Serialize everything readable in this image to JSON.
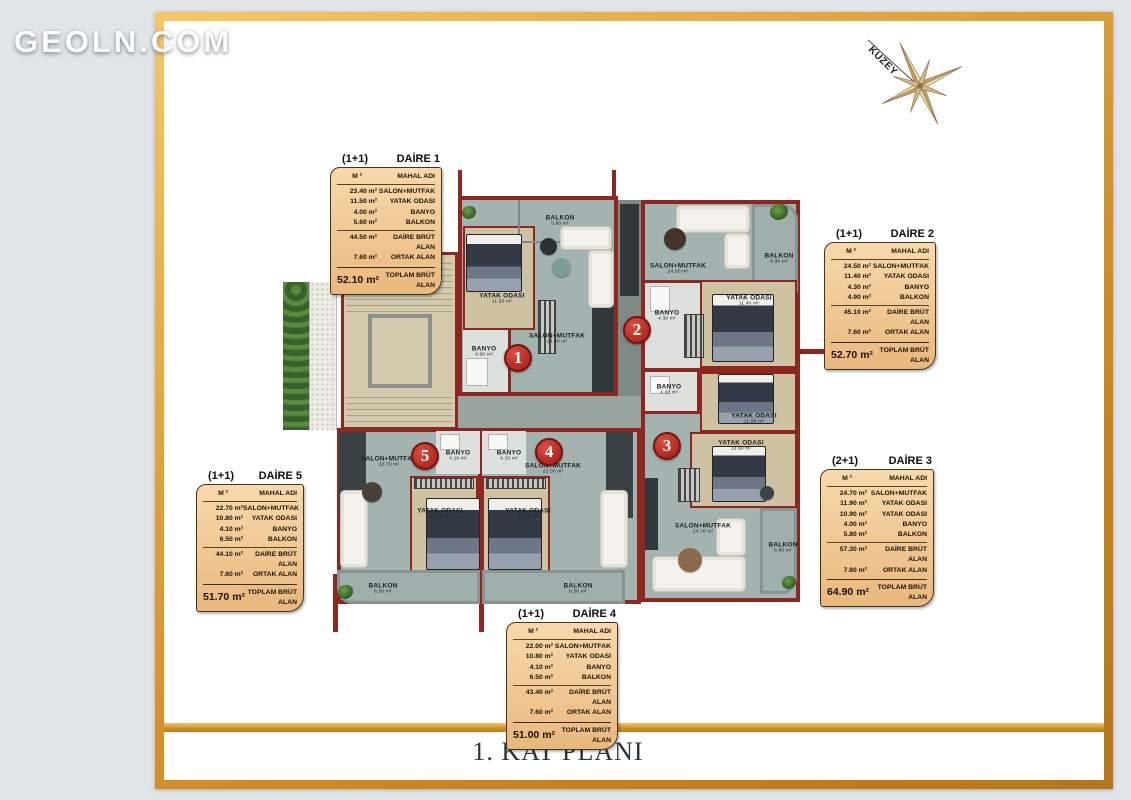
{
  "logo": "GEOLN.COM",
  "compass": {
    "label": "KUZEY"
  },
  "floor_title": "1. KAT PLANI",
  "colors": {
    "frame_gold": "#d99b35",
    "wall_red": "#8e2720",
    "card_bg": "#f3cf9d",
    "badge_red": "#c23a31",
    "floor_gray_green": "#a3b3af",
    "bedroom_beige": "#cfc2a2",
    "page_bg": "#e0e5e8"
  },
  "cards": [
    {
      "type": "(1+1)",
      "name": "DAİRE 1",
      "col_area": "M ²",
      "col_room": "MAHAL ADI",
      "rows": [
        [
          "23.40 m²",
          "SALON+MUTFAK"
        ],
        [
          "11.50 m²",
          "YATAK ODASI"
        ],
        [
          "4.00 m²",
          "BANYO"
        ],
        [
          "5.60 m²",
          "BALKON"
        ]
      ],
      "subtotal": [
        [
          "44.50 m²",
          "DAİRE BRÜT ALAN"
        ],
        [
          "7.60 m²",
          "ORTAK ALAN"
        ]
      ],
      "total": [
        "52.10 m²",
        "TOPLAM BRÜT ALAN"
      ]
    },
    {
      "type": "(1+1)",
      "name": "DAİRE 2",
      "col_area": "M ²",
      "col_room": "MAHAL ADI",
      "rows": [
        [
          "24.50 m²",
          "SALON+MUTFAK"
        ],
        [
          "11.40 m²",
          "YATAK ODASI"
        ],
        [
          "4.30 m²",
          "BANYO"
        ],
        [
          "4.90 m²",
          "BALKON"
        ]
      ],
      "subtotal": [
        [
          "45.10 m²",
          "DAİRE BRÜT ALAN"
        ],
        [
          "7.60 m²",
          "ORTAK ALAN"
        ]
      ],
      "total": [
        "52.70 m²",
        "TOPLAM BRÜT ALAN"
      ]
    },
    {
      "type": "(2+1)",
      "name": "DAİRE 3",
      "col_area": "M ²",
      "col_room": "MAHAL ADI",
      "rows": [
        [
          "24.70 m²",
          "SALON+MUTFAK"
        ],
        [
          "11.90 m²",
          "YATAK ODASI"
        ],
        [
          "10.90 m²",
          "YATAK ODASI"
        ],
        [
          "4.00 m²",
          "BANYO"
        ],
        [
          "5.80 m²",
          "BALKON"
        ]
      ],
      "subtotal": [
        [
          "57.30 m²",
          "DAİRE BRÜT ALAN"
        ],
        [
          "7.60 m²",
          "ORTAK ALAN"
        ]
      ],
      "total": [
        "64.90 m²",
        "TOPLAM BRÜT ALAN"
      ]
    },
    {
      "type": "(1+1)",
      "name": "DAİRE 4",
      "col_area": "M ²",
      "col_room": "MAHAL ADI",
      "rows": [
        [
          "22.00 m²",
          "SALON+MUTFAK"
        ],
        [
          "10.80 m²",
          "YATAK ODASI"
        ],
        [
          "4.10 m²",
          "BANYO"
        ],
        [
          "6.50 m²",
          "BALKON"
        ]
      ],
      "subtotal": [
        [
          "43.40 m²",
          "DAİRE BRÜT ALAN"
        ],
        [
          "7.60 m²",
          "ORTAK ALAN"
        ]
      ],
      "total": [
        "51.00 m²",
        "TOPLAM BRÜT ALAN"
      ]
    },
    {
      "type": "(1+1)",
      "name": "DAİRE 5",
      "col_area": "M ²",
      "col_room": "MAHAL ADI",
      "rows": [
        [
          "22.70 m²",
          "SALON+MUTFAK"
        ],
        [
          "10.80 m²",
          "YATAK ODASI"
        ],
        [
          "4.10 m²",
          "BANYO"
        ],
        [
          "6.50 m²",
          "BALKON"
        ]
      ],
      "subtotal": [
        [
          "44.10 m²",
          "DAİRE BRÜT ALAN"
        ],
        [
          "7.60 m²",
          "ORTAK ALAN"
        ]
      ],
      "total": [
        "51.70 m²",
        "TOPLAM BRÜT ALAN"
      ]
    }
  ],
  "plan": {
    "units": [
      "1",
      "2",
      "3",
      "4",
      "5"
    ],
    "rooms": [
      {
        "name": "BALKON",
        "area": "5.60 m²"
      },
      {
        "name": "YATAK ODASI",
        "area": "11.50 m²"
      },
      {
        "name": "BANYO",
        "area": "4.00 m²"
      },
      {
        "name": "SALON+MUTFAK",
        "area": "23.40 m²"
      },
      {
        "name": "SALON+MUTFAK",
        "area": "24.50 m²"
      },
      {
        "name": "BALKON",
        "area": "4.90 m²"
      },
      {
        "name": "YATAK ODASI",
        "area": "11.40 m²"
      },
      {
        "name": "BANYO",
        "area": "4.30 m²"
      },
      {
        "name": "BANYO",
        "area": "4.00 m²"
      },
      {
        "name": "YATAK ODASI",
        "area": "11.90 m²"
      },
      {
        "name": "YATAK ODASI",
        "area": "10.90 m²"
      },
      {
        "name": "SALON+MUTFAK",
        "area": "24.70 m²"
      },
      {
        "name": "BALKON",
        "area": "5.80 m²"
      },
      {
        "name": "SALON+MUTFAK",
        "area": "22.70 m²"
      },
      {
        "name": "BANYO",
        "area": "4.10 m²"
      },
      {
        "name": "BANYO",
        "area": "4.10 m²"
      },
      {
        "name": "SALON+MUTFAK",
        "area": "22.00 m²"
      },
      {
        "name": "YATAK ODASI",
        "area": "10.80 m²"
      },
      {
        "name": "YATAK ODASI",
        "area": "10.80 m²"
      },
      {
        "name": "BALKON",
        "area": "6.50 m²"
      },
      {
        "name": "BALKON",
        "area": "6.50 m²"
      }
    ]
  }
}
